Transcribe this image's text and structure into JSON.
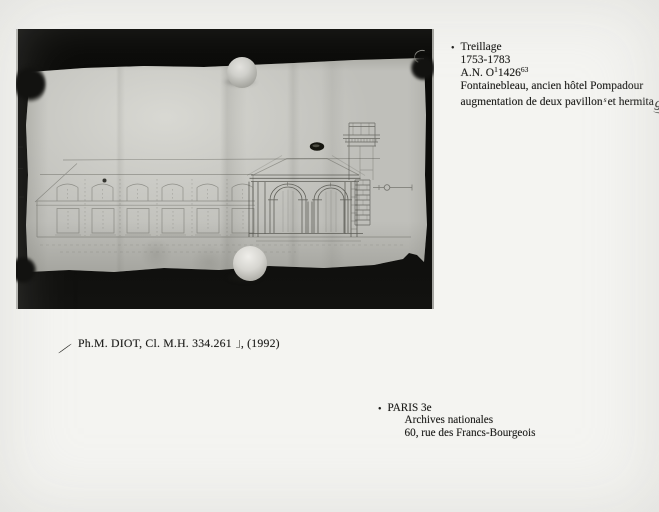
{
  "annotation": {
    "bullet": "•",
    "line1": "Treillage",
    "line2": "1753-1783",
    "line3_prefix": "A.N. O",
    "line3_sup1": "1",
    "line3_num": "1426",
    "line3_sup2": "63",
    "line4": "Fontainebleau, ancien hôtel Pompadour",
    "line5_part1": "augmentation de deux pavillon",
    "line5_insert": "s",
    "line5_part2": "et hermita",
    "line5_handwritten": "ge"
  },
  "caption": {
    "text": "Ph.M. DIOT, Cl. M.H. 334.261",
    "suffix": ", (1992)"
  },
  "address": {
    "bullet": "•",
    "line1": "PARIS 3e",
    "line2": "Archives nationales",
    "line3": "60, rue des Francs-Bourgeois"
  },
  "photo": {
    "subject": "Black-and-white photograph of a faint architectural elevation drawing (long wing with arched windows and an arcaded pavilion) on creased paper held flat by round weights and dark corner clips"
  },
  "colors": {
    "page_background": "#f4f4f1",
    "photo_black": "#0b0b09",
    "paper_gray": "#bfbfba",
    "drawing_ink": "#45453f",
    "text_ink": "#1c1c1a"
  }
}
